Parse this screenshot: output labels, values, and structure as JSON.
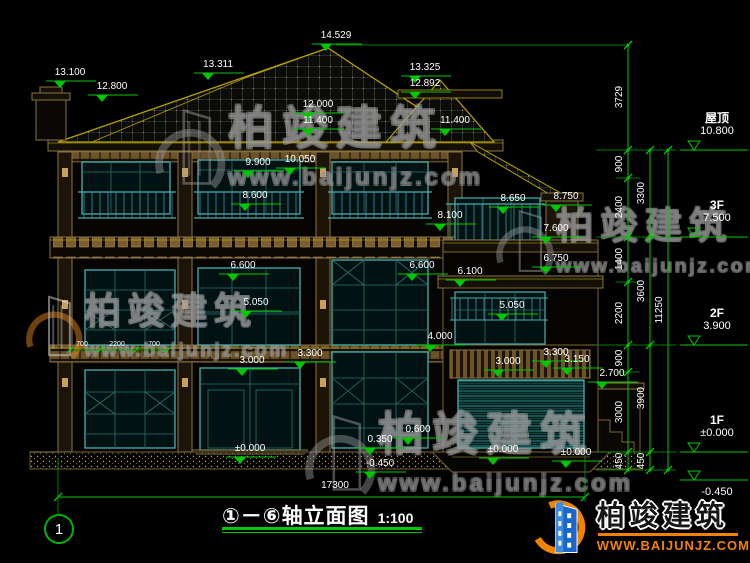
{
  "meta": {
    "drawing_number": "1",
    "title_axis": "①－⑥",
    "title_name": "轴立面图",
    "title_scale": "1:100"
  },
  "watermark": {
    "brand": "柏竣建筑",
    "site": "www.baijunjz.com"
  },
  "logo": {
    "brand": "柏竣建筑",
    "site": "www.baijunjz.com"
  },
  "colors": {
    "dimension_green": "#00c800",
    "window_teal": "#49b0b0",
    "structure_brown": "#8a7340",
    "logo_blue": "#1b66c9",
    "logo_orange": "#f08300"
  },
  "levels": [
    {
      "label": "屋顶",
      "elev": "10.800",
      "y": 150
    },
    {
      "label": "3F",
      "elev": "7.500",
      "y": 237
    },
    {
      "label": "2F",
      "elev": "3.900",
      "y": 345
    },
    {
      "label": "1F",
      "elev": "±0.000",
      "y": 452
    },
    {
      "label": "",
      "elev": "-0.450",
      "y": 480
    }
  ],
  "elevation_markers": [
    {
      "v": "14.529",
      "x": 336,
      "y": 31
    },
    {
      "v": "13.311",
      "x": 218,
      "y": 60
    },
    {
      "v": "13.100",
      "x": 70,
      "y": 68
    },
    {
      "v": "12.800",
      "x": 112,
      "y": 82
    },
    {
      "v": "13.325",
      "x": 425,
      "y": 63
    },
    {
      "v": "12.892",
      "x": 425,
      "y": 79
    },
    {
      "v": "12.000",
      "x": 318,
      "y": 100
    },
    {
      "v": "11.400",
      "x": 318,
      "y": 116
    },
    {
      "v": "11.400",
      "x": 455,
      "y": 116
    },
    {
      "v": "10.050",
      "x": 300,
      "y": 155
    },
    {
      "v": "9.900",
      "x": 258,
      "y": 158
    },
    {
      "v": "8.600",
      "x": 255,
      "y": 191
    },
    {
      "v": "8.650",
      "x": 513,
      "y": 194
    },
    {
      "v": "8.750",
      "x": 566,
      "y": 192
    },
    {
      "v": "8.100",
      "x": 450,
      "y": 211
    },
    {
      "v": "7.600",
      "x": 556,
      "y": 224
    },
    {
      "v": "6.750",
      "x": 556,
      "y": 254
    },
    {
      "v": "6.600",
      "x": 243,
      "y": 261
    },
    {
      "v": "6.600",
      "x": 422,
      "y": 261
    },
    {
      "v": "6.100",
      "x": 470,
      "y": 267
    },
    {
      "v": "5.050",
      "x": 256,
      "y": 298
    },
    {
      "v": "5.050",
      "x": 512,
      "y": 301
    },
    {
      "v": "4.000",
      "x": 440,
      "y": 332
    },
    {
      "v": "3.300",
      "x": 310,
      "y": 349
    },
    {
      "v": "3.300",
      "x": 556,
      "y": 348
    },
    {
      "v": "3.150",
      "x": 577,
      "y": 355
    },
    {
      "v": "3.000",
      "x": 252,
      "y": 356
    },
    {
      "v": "3.000",
      "x": 508,
      "y": 357
    },
    {
      "v": "2.700",
      "x": 612,
      "y": 369
    },
    {
      "v": "0.600",
      "x": 418,
      "y": 425
    },
    {
      "v": "0.350",
      "x": 380,
      "y": 435
    },
    {
      "v": "±0.000",
      "x": 250,
      "y": 444
    },
    {
      "v": "±0.000",
      "x": 503,
      "y": 445
    },
    {
      "v": "±0.000",
      "x": 576,
      "y": 448
    },
    {
      "v": "-0.450",
      "x": 380,
      "y": 459
    }
  ],
  "right_chains": [
    {
      "x": 628,
      "boundaries": [
        45,
        150,
        178,
        237,
        282,
        345,
        372,
        452,
        470
      ],
      "labels": [
        {
          "v": "3729",
          "y": 97
        },
        {
          "v": "900",
          "y": 164
        },
        {
          "v": "2400",
          "y": 207
        },
        {
          "v": "1400",
          "y": 259
        },
        {
          "v": "2200",
          "y": 313
        },
        {
          "v": "900",
          "y": 358
        },
        {
          "v": "3000",
          "y": 412
        },
        {
          "v": "450",
          "y": 461
        }
      ]
    },
    {
      "x": 650,
      "boundaries": [
        150,
        237,
        345,
        452,
        470
      ],
      "labels": [
        {
          "v": "3300",
          "y": 193
        },
        {
          "v": "3600",
          "y": 291
        },
        {
          "v": "3900",
          "y": 398
        },
        {
          "v": "450",
          "y": 461
        }
      ]
    },
    {
      "x": 668,
      "boundaries": [
        150,
        470
      ],
      "labels": [
        {
          "v": "11250",
          "y": 310
        }
      ]
    }
  ],
  "bottom_dimension": {
    "v": "17300",
    "x1": 58,
    "x2": 585,
    "y": 497,
    "label_x": 335,
    "label_y": 481
  },
  "small_dims": [
    {
      "v": "700",
      "x": 82,
      "y": 341
    },
    {
      "v": "2200",
      "x": 117,
      "y": 341
    },
    {
      "v": "700",
      "x": 154,
      "y": 341
    }
  ]
}
